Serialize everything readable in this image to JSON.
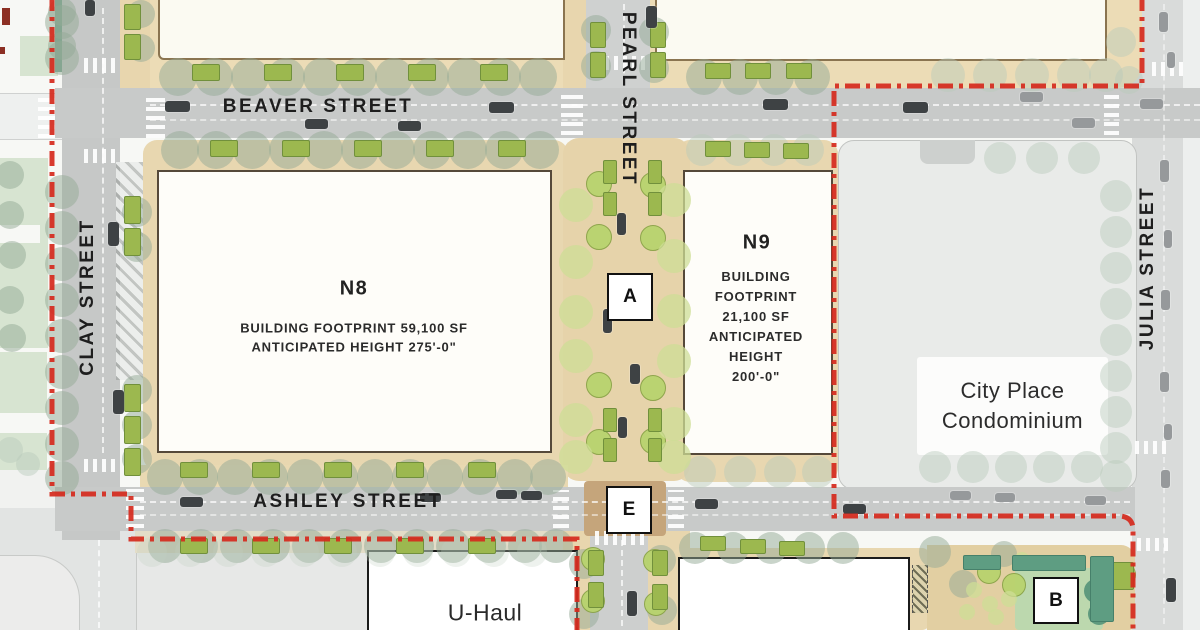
{
  "streets": {
    "beaver": "BEAVER STREET",
    "ashley": "ASHLEY STREET",
    "clay": "CLAY STREET",
    "pearl": "PEARL STREET",
    "julia": "JULIA STREET"
  },
  "parcels": {
    "n8": {
      "name": "N8",
      "footprint": "BUILDING FOOTPRINT 59,100 SF",
      "height": "ANTICIPATED HEIGHT 275'-0\""
    },
    "n9": {
      "name": "N9",
      "lines": [
        "BUILDING",
        "FOOTPRINT",
        "21,100 SF",
        "ANTICIPATED",
        "HEIGHT",
        "200'-0\""
      ]
    },
    "city_place": {
      "line1": "City Place",
      "line2": "Condominium"
    },
    "u_haul": {
      "name": "U-Haul"
    }
  },
  "markers": {
    "a": "A",
    "e": "E",
    "b": "B"
  },
  "legend_colors": {
    "boundary_red": "#d52b1e",
    "road_gray": "#c8cac9",
    "sidewalk_tan": "#e6d3aa",
    "tree_sage": "#93a996",
    "tree_lime": "#b8d36e",
    "planter_olive": "#9cb84f"
  }
}
